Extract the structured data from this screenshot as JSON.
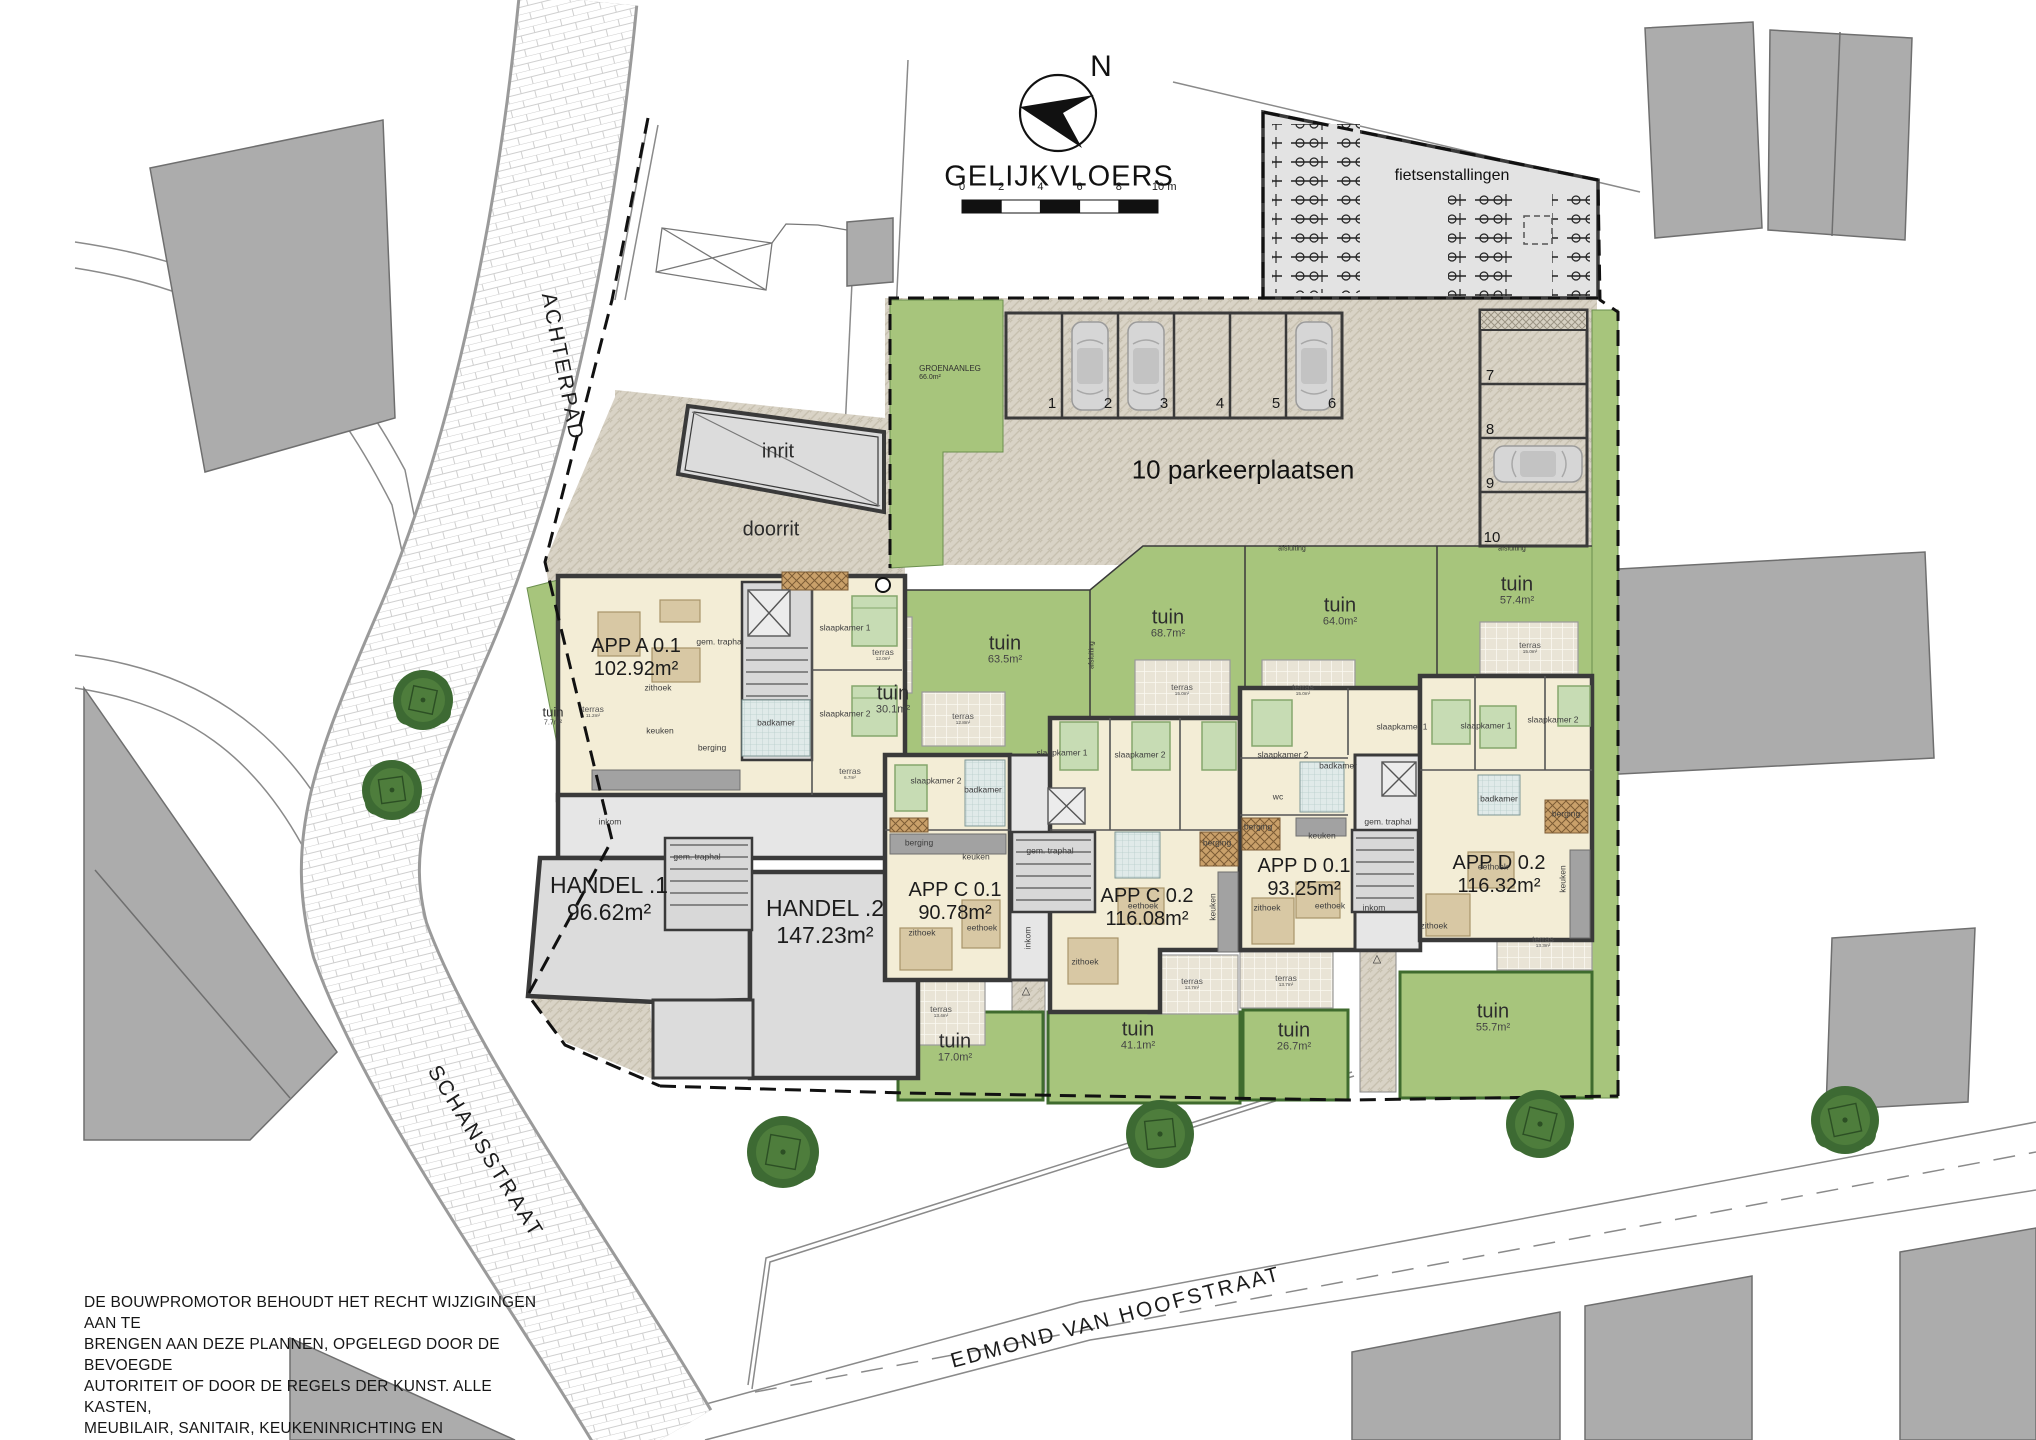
{
  "title": {
    "main": "GELIJKVLOERS",
    "north_letter": "N",
    "scale_unit": "m",
    "scale_ticks": [
      "0",
      "2",
      "4",
      "6",
      "8",
      "10"
    ]
  },
  "streets": {
    "achterpad": "ACHTERPAD",
    "schansstraat": "SCHANSSTRAAT",
    "edmond": "EDMOND VAN HOOFSTRAAT"
  },
  "site_labels": {
    "inrit": "inrit",
    "doorrit": "doorrit",
    "parking": "10 parkeerplaatsen",
    "bike_storage": "fietsenstallingen"
  },
  "green_label": {
    "name": "GROENAANLEG",
    "area": "66.0m²"
  },
  "units": [
    {
      "name": "APP A 0.1",
      "area": "102.92m²"
    },
    {
      "name": "HANDEL .1",
      "area": "96.62m²"
    },
    {
      "name": "HANDEL .2",
      "area": "147.23m²"
    },
    {
      "name": "APP C 0.1",
      "area": "90.78m²"
    },
    {
      "name": "APP C 0.2",
      "area": "116.08m²"
    },
    {
      "name": "APP D 0.1",
      "area": "93.25m²"
    },
    {
      "name": "APP D 0.2",
      "area": "116.32m²"
    }
  ],
  "parking_numbers": [
    "1",
    "2",
    "3",
    "4",
    "5",
    "6",
    "7",
    "8",
    "9",
    "10"
  ],
  "gardens": [
    {
      "label": "tuin",
      "area": "7.7m²",
      "x": 553,
      "y": 716,
      "s": 13
    },
    {
      "label": "tuin",
      "area": "30.1m²",
      "x": 893,
      "y": 700
    },
    {
      "label": "tuin",
      "area": "63.5m²",
      "x": 1005,
      "y": 650
    },
    {
      "label": "tuin",
      "area": "68.7m²",
      "x": 1168,
      "y": 624
    },
    {
      "label": "tuin",
      "area": "64.0m²",
      "x": 1340,
      "y": 612
    },
    {
      "label": "tuin",
      "area": "57.4m²",
      "x": 1517,
      "y": 591
    },
    {
      "label": "tuin",
      "area": "17.0m²",
      "x": 955,
      "y": 1048
    },
    {
      "label": "tuin",
      "area": "41.1m²",
      "x": 1138,
      "y": 1036
    },
    {
      "label": "tuin",
      "area": "26.7m²",
      "x": 1294,
      "y": 1037
    },
    {
      "label": "tuin",
      "area": "55.7m²",
      "x": 1493,
      "y": 1018
    }
  ],
  "terraces": [
    {
      "label": "terras",
      "area": "11.2m²",
      "x": 593,
      "y": 712
    },
    {
      "label": "terras",
      "area": "6.7m²",
      "x": 850,
      "y": 774
    },
    {
      "label": "terras",
      "area": "12.0m²",
      "x": 883,
      "y": 655
    },
    {
      "label": "terras",
      "area": "12.8m²",
      "x": 963,
      "y": 719
    },
    {
      "label": "terras",
      "area": "15.0m²",
      "x": 1182,
      "y": 690
    },
    {
      "label": "terras",
      "area": "15.0m²",
      "x": 1303,
      "y": 690
    },
    {
      "label": "terras",
      "area": "15.0m²",
      "x": 1530,
      "y": 648
    },
    {
      "label": "terras",
      "area": "13.4m²",
      "x": 941,
      "y": 1012
    },
    {
      "label": "terras",
      "area": "13.7m²",
      "x": 1192,
      "y": 984
    },
    {
      "label": "terras",
      "area": "13.7m²",
      "x": 1286,
      "y": 981
    },
    {
      "label": "terras",
      "area": "13.3m²",
      "x": 1543,
      "y": 942
    }
  ],
  "rooms": [
    {
      "t": "zithoek",
      "x": 658,
      "y": 688
    },
    {
      "t": "keuken",
      "x": 660,
      "y": 731
    },
    {
      "t": "berging",
      "x": 712,
      "y": 748
    },
    {
      "t": "badkamer",
      "x": 776,
      "y": 723
    },
    {
      "t": "slaapkamer 1",
      "x": 845,
      "y": 628
    },
    {
      "t": "slaapkamer 2",
      "x": 845,
      "y": 714
    },
    {
      "t": "gem. traphal",
      "x": 720,
      "y": 642
    },
    {
      "t": "inkom",
      "x": 610,
      "y": 822
    },
    {
      "t": "gem. traphal",
      "x": 697,
      "y": 857
    },
    {
      "t": "berging",
      "x": 919,
      "y": 843
    },
    {
      "t": "keuken",
      "x": 976,
      "y": 857
    },
    {
      "t": "zithoek",
      "x": 922,
      "y": 933
    },
    {
      "t": "eethoek",
      "x": 982,
      "y": 928
    },
    {
      "t": "slaapkamer 2",
      "x": 936,
      "y": 781
    },
    {
      "t": "badkamer",
      "x": 983,
      "y": 790
    },
    {
      "t": "gem. traphal",
      "x": 1050,
      "y": 851
    },
    {
      "t": "inkom",
      "x": 1028,
      "y": 938,
      "r": -90
    },
    {
      "t": "slaapkamer 1",
      "x": 1062,
      "y": 753
    },
    {
      "t": "slaapkamer 2",
      "x": 1140,
      "y": 755
    },
    {
      "t": "eethoek",
      "x": 1143,
      "y": 906
    },
    {
      "t": "zithoek",
      "x": 1085,
      "y": 962
    },
    {
      "t": "keuken",
      "x": 1213,
      "y": 907,
      "r": -90
    },
    {
      "t": "berging",
      "x": 1217,
      "y": 843
    },
    {
      "t": "berging",
      "x": 1258,
      "y": 827
    },
    {
      "t": "keuken",
      "x": 1322,
      "y": 836
    },
    {
      "t": "zithoek",
      "x": 1267,
      "y": 908
    },
    {
      "t": "eethoek",
      "x": 1330,
      "y": 906
    },
    {
      "t": "slaapkamer 2",
      "x": 1283,
      "y": 755
    },
    {
      "t": "badkamer",
      "x": 1338,
      "y": 766
    },
    {
      "t": "wc",
      "x": 1278,
      "y": 797
    },
    {
      "t": "gem. traphal",
      "x": 1388,
      "y": 822
    },
    {
      "t": "inkom",
      "x": 1374,
      "y": 908
    },
    {
      "t": "slaapkamer 1",
      "x": 1402,
      "y": 727
    },
    {
      "t": "slaapkamer 1",
      "x": 1486,
      "y": 726
    },
    {
      "t": "slaapkamer 2",
      "x": 1553,
      "y": 720
    },
    {
      "t": "badkamer",
      "x": 1499,
      "y": 799
    },
    {
      "t": "berging",
      "x": 1566,
      "y": 814
    },
    {
      "t": "eethoek",
      "x": 1493,
      "y": 867
    },
    {
      "t": "zithoek",
      "x": 1434,
      "y": 926
    },
    {
      "t": "keuken",
      "x": 1563,
      "y": 879,
      "r": -90
    }
  ],
  "misc": [
    {
      "t": "afsluiting",
      "x": 1292,
      "y": 549,
      "s": 7
    },
    {
      "t": "afsluiting",
      "x": 1512,
      "y": 549,
      "s": 7
    },
    {
      "t": "afsluiting",
      "x": 1092,
      "y": 655,
      "s": 7,
      "r": -90
    },
    {
      "t": "△",
      "x": 1026,
      "y": 992,
      "s": 11
    },
    {
      "t": "△",
      "x": 1377,
      "y": 960,
      "s": 11
    }
  ],
  "disclaimer": [
    "DE BOUWPROMOTOR BEHOUDT HET RECHT WIJZIGINGEN AAN TE",
    "BRENGEN AAN DEZE PLANNEN, OPGELEGD DOOR DE BEVOEGDE",
    "AUTORITEIT OF DOOR DE REGELS DER KUNST. ALLE KASTEN,",
    "MEUBILAIR, SANITAIR, KEUKENINRICHTING EN BENADERENDE",
    "MAATVOERING ZIJN ENKEL TER ILLUSTRATIE WEERGEGEVEN."
  ]
}
